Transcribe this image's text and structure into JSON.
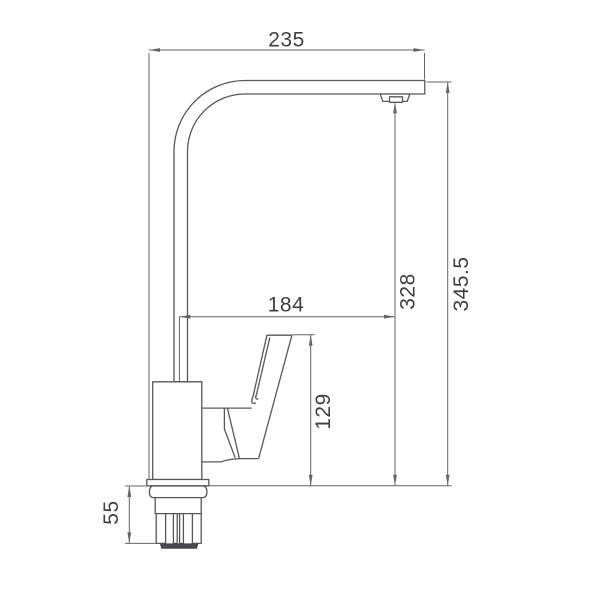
{
  "page": {
    "background": "#ffffff"
  },
  "drawing": {
    "line_color": "#57585b",
    "dimension_color": "#63656a",
    "text_color": "#3e3f42",
    "dark_band_color": "#47484b",
    "dimensions": {
      "spout_width": {
        "value": "235"
      },
      "overall_height": {
        "value": "345.5"
      },
      "outlet_height": {
        "value": "328"
      },
      "spout_reach": {
        "value": "184"
      },
      "handle_height": {
        "value": "129"
      },
      "base_depth": {
        "value": "55"
      }
    }
  }
}
